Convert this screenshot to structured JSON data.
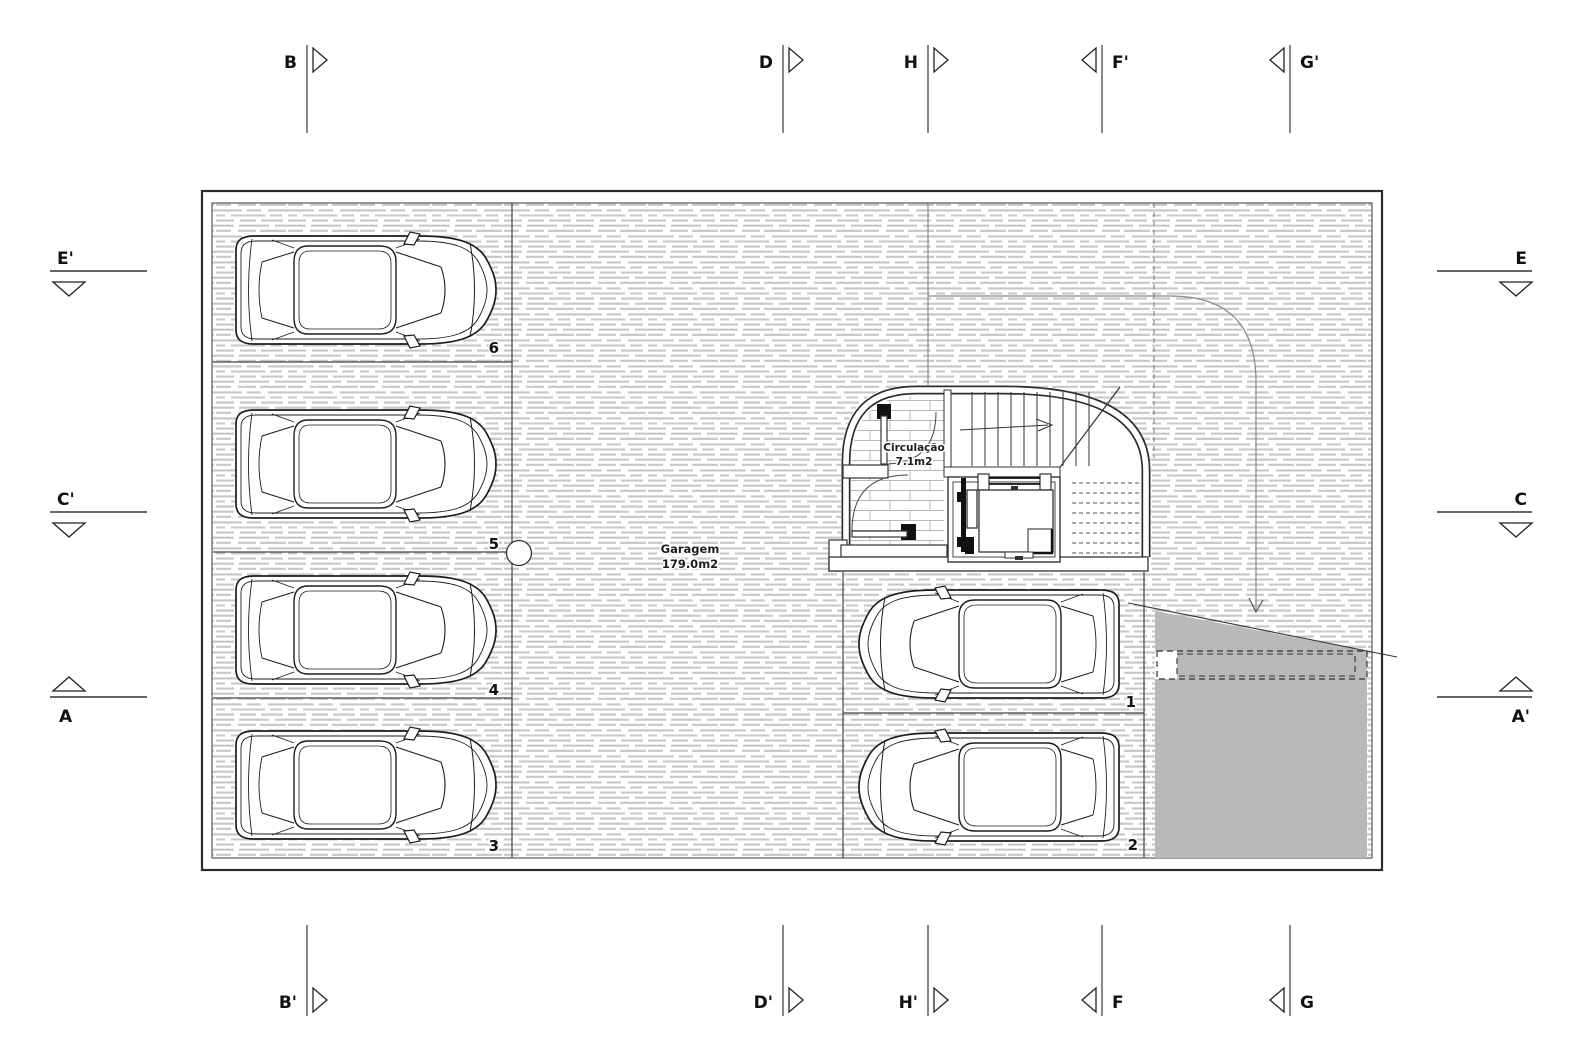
{
  "drawing": {
    "rooms": {
      "garage": {
        "name": "Garagem",
        "area": "179.0m2"
      },
      "circulation": {
        "name": "Circulação",
        "area": "7.1m2"
      }
    },
    "parking_spaces": [
      "1",
      "2",
      "3",
      "4",
      "5",
      "6"
    ]
  },
  "markers": {
    "top": [
      {
        "label": "B"
      },
      {
        "label": "D"
      },
      {
        "label": "H"
      },
      {
        "label": "F'"
      },
      {
        "label": "G'"
      }
    ],
    "bottom": [
      {
        "label": "B'"
      },
      {
        "label": "D'"
      },
      {
        "label": "H'"
      },
      {
        "label": "F"
      },
      {
        "label": "G"
      }
    ],
    "left": [
      {
        "label": "E'"
      },
      {
        "label": "C'"
      },
      {
        "label": "A"
      }
    ],
    "right": [
      {
        "label": "E"
      },
      {
        "label": "C"
      },
      {
        "label": "A'"
      }
    ]
  },
  "colors": {
    "ramp": "#b9b9b9",
    "hatch": "#c7c7c7",
    "wall": "#2a2a2a"
  }
}
